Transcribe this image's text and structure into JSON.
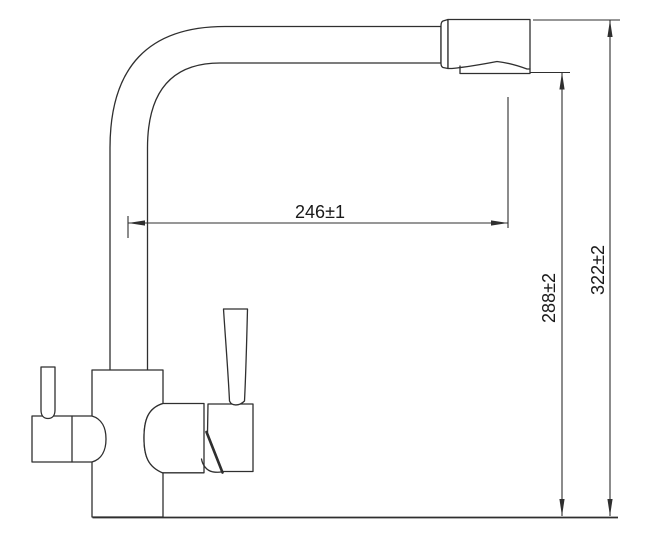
{
  "dimensions": {
    "spout_reach": "246±1",
    "spout_outlet_height": "288±2",
    "overall_height": "322±2"
  },
  "colors": {
    "background": "#ffffff",
    "line": "#2f2f2f",
    "dimension_text": "#1a1a1a"
  }
}
